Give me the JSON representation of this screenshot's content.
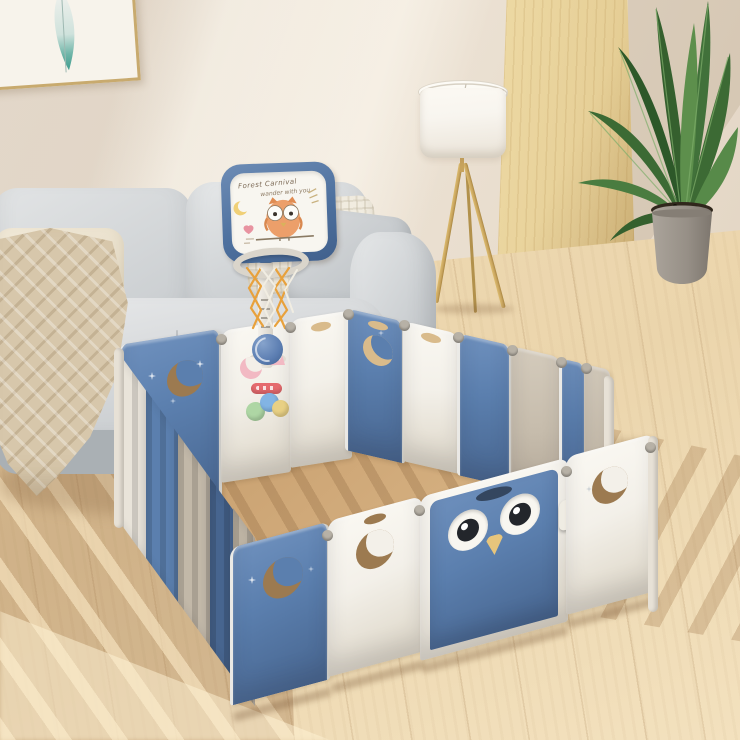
{
  "scene": {
    "description": "Product lifestyle photo: blue and white foldable baby playpen with owl gate and basketball hoop, in a sunlit living room with gray sofa, tripod floor lamp, wood partition and potted plant on wood floor",
    "objects": {
      "wall_art": "framed feather watercolor print",
      "sofa": "light gray fabric sofa with cushions, cream pillows and knit throw blanket",
      "floor_lamp": "tripod floor lamp with white drum shade and gold legs",
      "wood_partition": "light wood panel leaning on wall",
      "plant": "potted broad-leaf plant in gray concrete pot",
      "playpen": "foldable baby playpen, alternating blue, white and taupe panels with moon, star and slat cutouts",
      "gate": "owl-face gate panel with eyes, beak and safety latch",
      "basketball_stand": "toy basketball hoop with drawing backboard, adjustable pole, net and blue ball",
      "activity_panel": "play panel with pink moon, crown, rings, rattle bar and spinner balls"
    }
  },
  "backboard": {
    "line1": "Forest Carnival",
    "line2": "wander with you"
  },
  "colors": {
    "wall": "#ece2d4",
    "floor": "#ebd5ac",
    "wood-panel": "#e6cf97",
    "art-gold": "#c8aa6e",
    "feather-teal": "#5aa89b",
    "sofa-light": "#e2e4e5",
    "sofa-mid": "#c6cacd",
    "sofa-dark": "#aab0b4",
    "pillow-cream": "#eae1cd",
    "throw-beige": "#d7c7ab",
    "lamp-shade": "#f8f5ef",
    "lamp-gold": "#c7a35d",
    "leaf-dark": "#2d5829",
    "leaf-mid": "#41713a",
    "leaf-light": "#5d8f4c",
    "pot-gray": "#9b948b",
    "pen-blue": "#5b7fae",
    "pen-blue-deep": "#47658f",
    "pen-white": "#f3f0e9",
    "pen-gray": "#c6bcac",
    "cut-dark": "#9c7a50",
    "cut-light": "#d9bb8b",
    "owl-orange": "#eb9e6a",
    "beak-yellow": "#e7c57c",
    "eye-dark": "#23262b",
    "net-orange": "#e8a13c",
    "ball-blue": "#5b7db1",
    "toy-pink": "#f2b9c3",
    "toy-red": "#e56a6e",
    "toy-green": "#aed6a4",
    "toy-blue": "#82b4e4",
    "toy-yellow": "#e8d084",
    "connector-gray": "#b7b1a6"
  }
}
